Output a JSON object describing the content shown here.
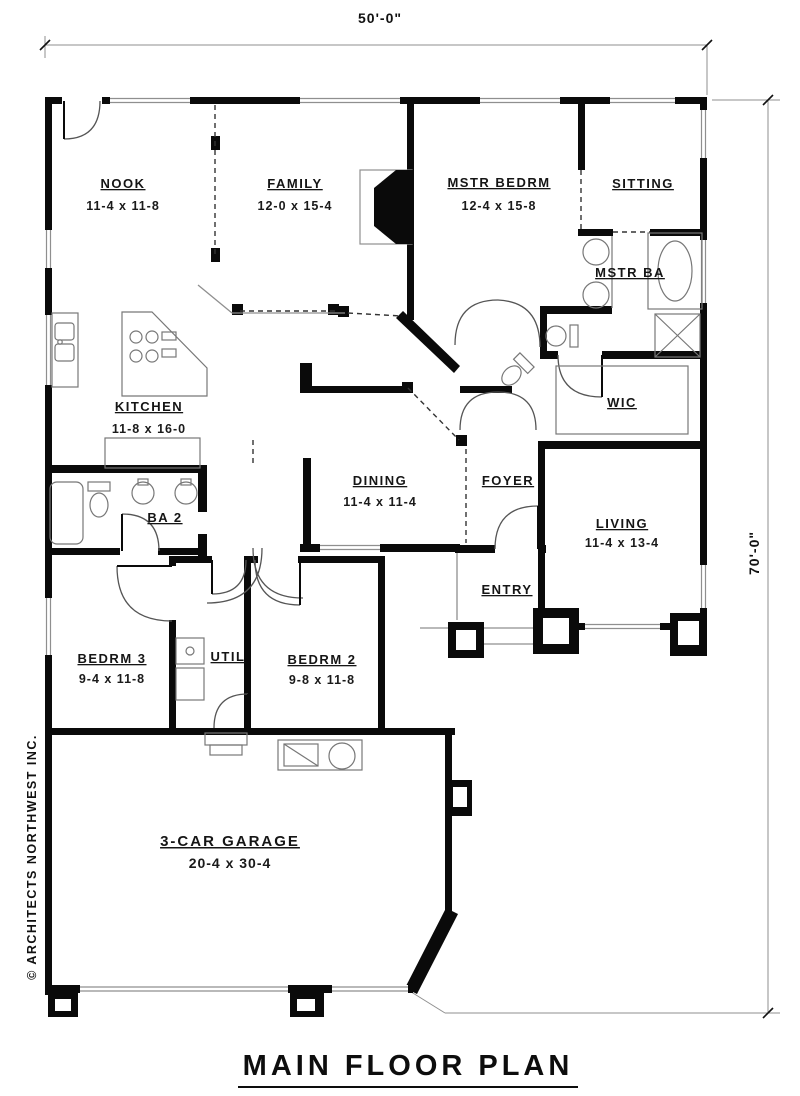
{
  "title": "MAIN FLOOR PLAN",
  "credit": "© ARCHITECTS NORTHWEST INC.",
  "dimension_labels": {
    "width": "50'-0\"",
    "height": "70'-0\""
  },
  "rooms": {
    "nook": {
      "name": "NOOK",
      "dims": "11-4 x 11-8"
    },
    "family": {
      "name": "FAMILY",
      "dims": "12-0 x 15-4"
    },
    "mstr_bedrm": {
      "name": "MSTR BEDRM",
      "dims": "12-4 x 15-8"
    },
    "sitting": {
      "name": "SITTING"
    },
    "mstr_ba": {
      "name": "MSTR BA"
    },
    "wic": {
      "name": "WIC"
    },
    "kitchen": {
      "name": "KITCHEN",
      "dims": "11-8 x 16-0"
    },
    "dining": {
      "name": "DINING",
      "dims": "11-4 x 11-4"
    },
    "foyer": {
      "name": "FOYER"
    },
    "living": {
      "name": "LIVING",
      "dims": "11-4 x 13-4"
    },
    "entry": {
      "name": "ENTRY"
    },
    "ba2": {
      "name": "BA 2"
    },
    "bedrm3": {
      "name": "BEDRM 3",
      "dims": "9-4 x 11-8"
    },
    "util": {
      "name": "UTIL"
    },
    "bedrm2": {
      "name": "BEDRM 2",
      "dims": "9-8 x 11-8"
    },
    "garage": {
      "name": "3-CAR GARAGE",
      "dims": "20-4 x 30-4"
    }
  },
  "colors": {
    "wall": "#0a0a0a",
    "thin_line": "#8f8f8f",
    "dashed": "#333333",
    "text": "#151515",
    "paper": "#ffffff"
  }
}
